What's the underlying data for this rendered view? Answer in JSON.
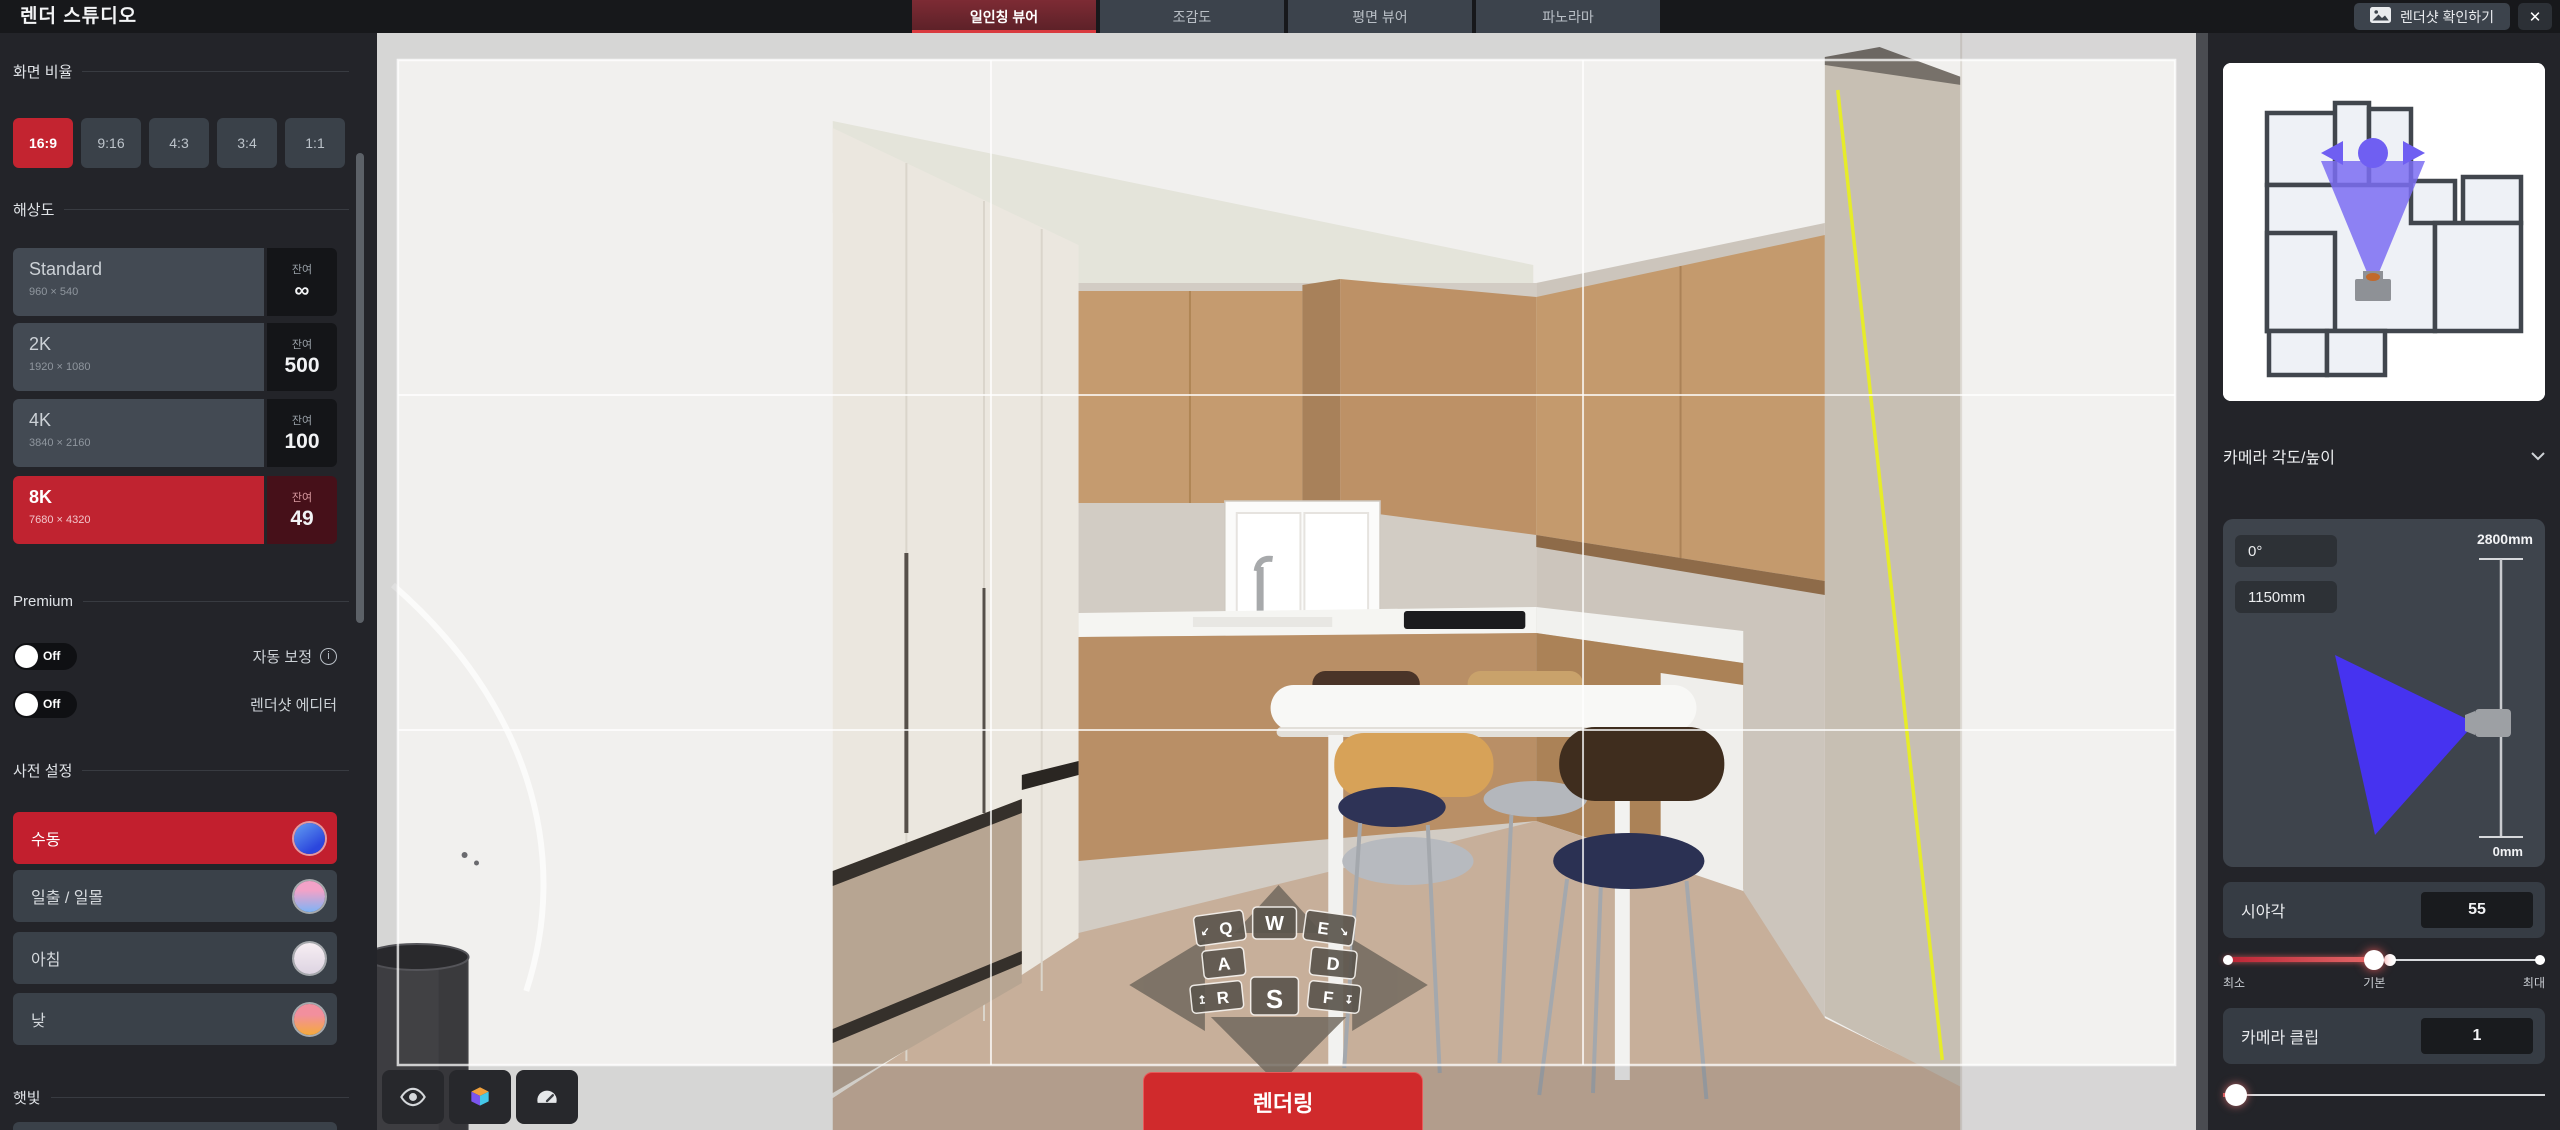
{
  "app": {
    "title": "렌더 스튜디오",
    "close_label": "✕"
  },
  "colors": {
    "accent_red": "#c32430",
    "cone_blue": "#4633f0",
    "minimap_cone": "#7b6df2",
    "guide_yellow": "#e6ec29"
  },
  "topbar": {
    "tabs": [
      {
        "label": "일인칭 뷰어",
        "active": true
      },
      {
        "label": "조감도",
        "active": false
      },
      {
        "label": "평면 뷰어",
        "active": false
      },
      {
        "label": "파노라마",
        "active": false
      }
    ],
    "rendershot_button": {
      "label": "렌더샷 확인하기"
    }
  },
  "sidebar_left": {
    "aspect": {
      "title": "화면 비율",
      "selected": "16:9",
      "options": [
        "16:9",
        "9:16",
        "4:3",
        "3:4",
        "1:1"
      ]
    },
    "resolution": {
      "title": "해상도",
      "remaining_label": "잔여",
      "selected": "8K",
      "options": [
        {
          "name": "Standard",
          "size": "960 × 540",
          "remaining": "∞"
        },
        {
          "name": "2K",
          "size": "1920 × 1080",
          "remaining": "500"
        },
        {
          "name": "4K",
          "size": "3840 × 2160",
          "remaining": "100"
        },
        {
          "name": "8K",
          "size": "7680 × 4320",
          "remaining": "49"
        }
      ]
    },
    "premium": {
      "title": "Premium",
      "toggle1": {
        "state": "Off",
        "label": "자동 보정"
      },
      "toggle2": {
        "state": "Off",
        "label": "렌더샷 에디터"
      }
    },
    "presets": {
      "title": "사전 설정",
      "selected": "수동",
      "options": [
        {
          "label": "수동",
          "swatch": "background:linear-gradient(145deg,#63a0f2 0%,#2b46dd 75%)"
        },
        {
          "label": "일출 / 일몰",
          "swatch": "background:linear-gradient(180deg,#f2a2c8 30%,#7fb3f5 100%)"
        },
        {
          "label": "아침",
          "swatch": "background:linear-gradient(180deg,#f7eef3,#ddd4e2)"
        },
        {
          "label": "낮",
          "swatch": "background:linear-gradient(180deg,#f28f9d 35%,#f5aa3c 100%)"
        }
      ]
    },
    "sunlight": {
      "title": "햇빛"
    }
  },
  "viewport": {
    "render_button": "렌더링",
    "nav_keys": {
      "q": "Q",
      "w": "W",
      "e": "E",
      "a": "A",
      "d": "D",
      "r": "R",
      "s": "S",
      "f": "F"
    }
  },
  "sidebar_right": {
    "camera": {
      "title": "카메라 각도/높이",
      "angle": "0°",
      "height": "1150mm",
      "height_max": "2800mm",
      "height_min": "0mm"
    },
    "fov": {
      "label": "시야각",
      "value": "55",
      "ticks": {
        "min": "최소",
        "mid": "기본",
        "max": "최대"
      }
    },
    "clip": {
      "label": "카메라 클립",
      "value": "1"
    }
  }
}
